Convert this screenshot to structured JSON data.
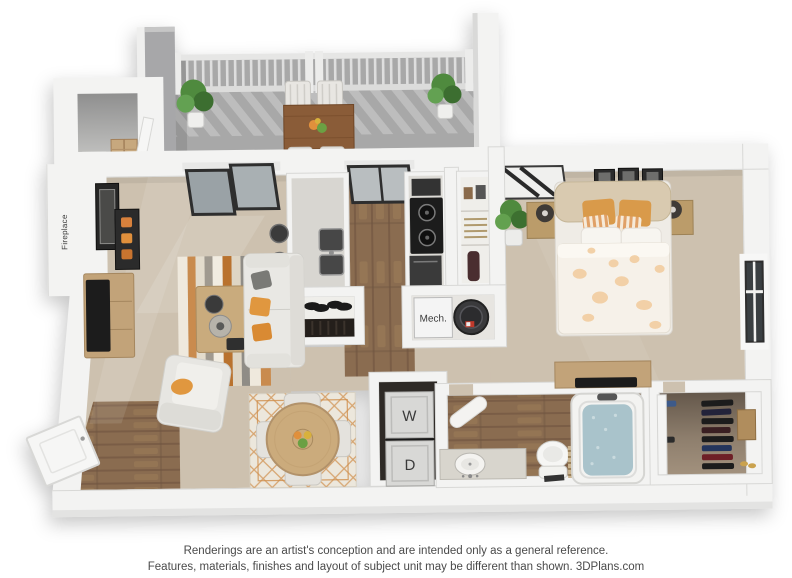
{
  "plan": {
    "labels": {
      "fireplace": "Fireplace",
      "mech": "Mech.",
      "washer": "W",
      "dryer": "D"
    }
  },
  "footer": {
    "line1": "Renderings are an artist's conception and are intended only as a general reference.",
    "line2": "Features, materials, finishes and layout of subject unit may be different than shown. 3DPlans.com"
  },
  "colors": {
    "wall": "#f3f3f2",
    "wall_edge": "#d8d8d6",
    "balcony_wall": "#a7a7a9",
    "balcony_floor": "#a8a8a8",
    "carpet": "#cdc1af",
    "wood": "#8a6c50",
    "wood_dark": "#6f5440",
    "closet_floor": "#a3927e",
    "rug_cream": "#ece7dc",
    "accent_orange": "#e0973f",
    "sofa": "#e9e8e4",
    "tv_black": "#1c1c1c",
    "water": "#a9c3cb",
    "plant_green": "#4f8a3e",
    "label_text": "#3a3a3a",
    "footer_text": "#4a4a4a"
  }
}
